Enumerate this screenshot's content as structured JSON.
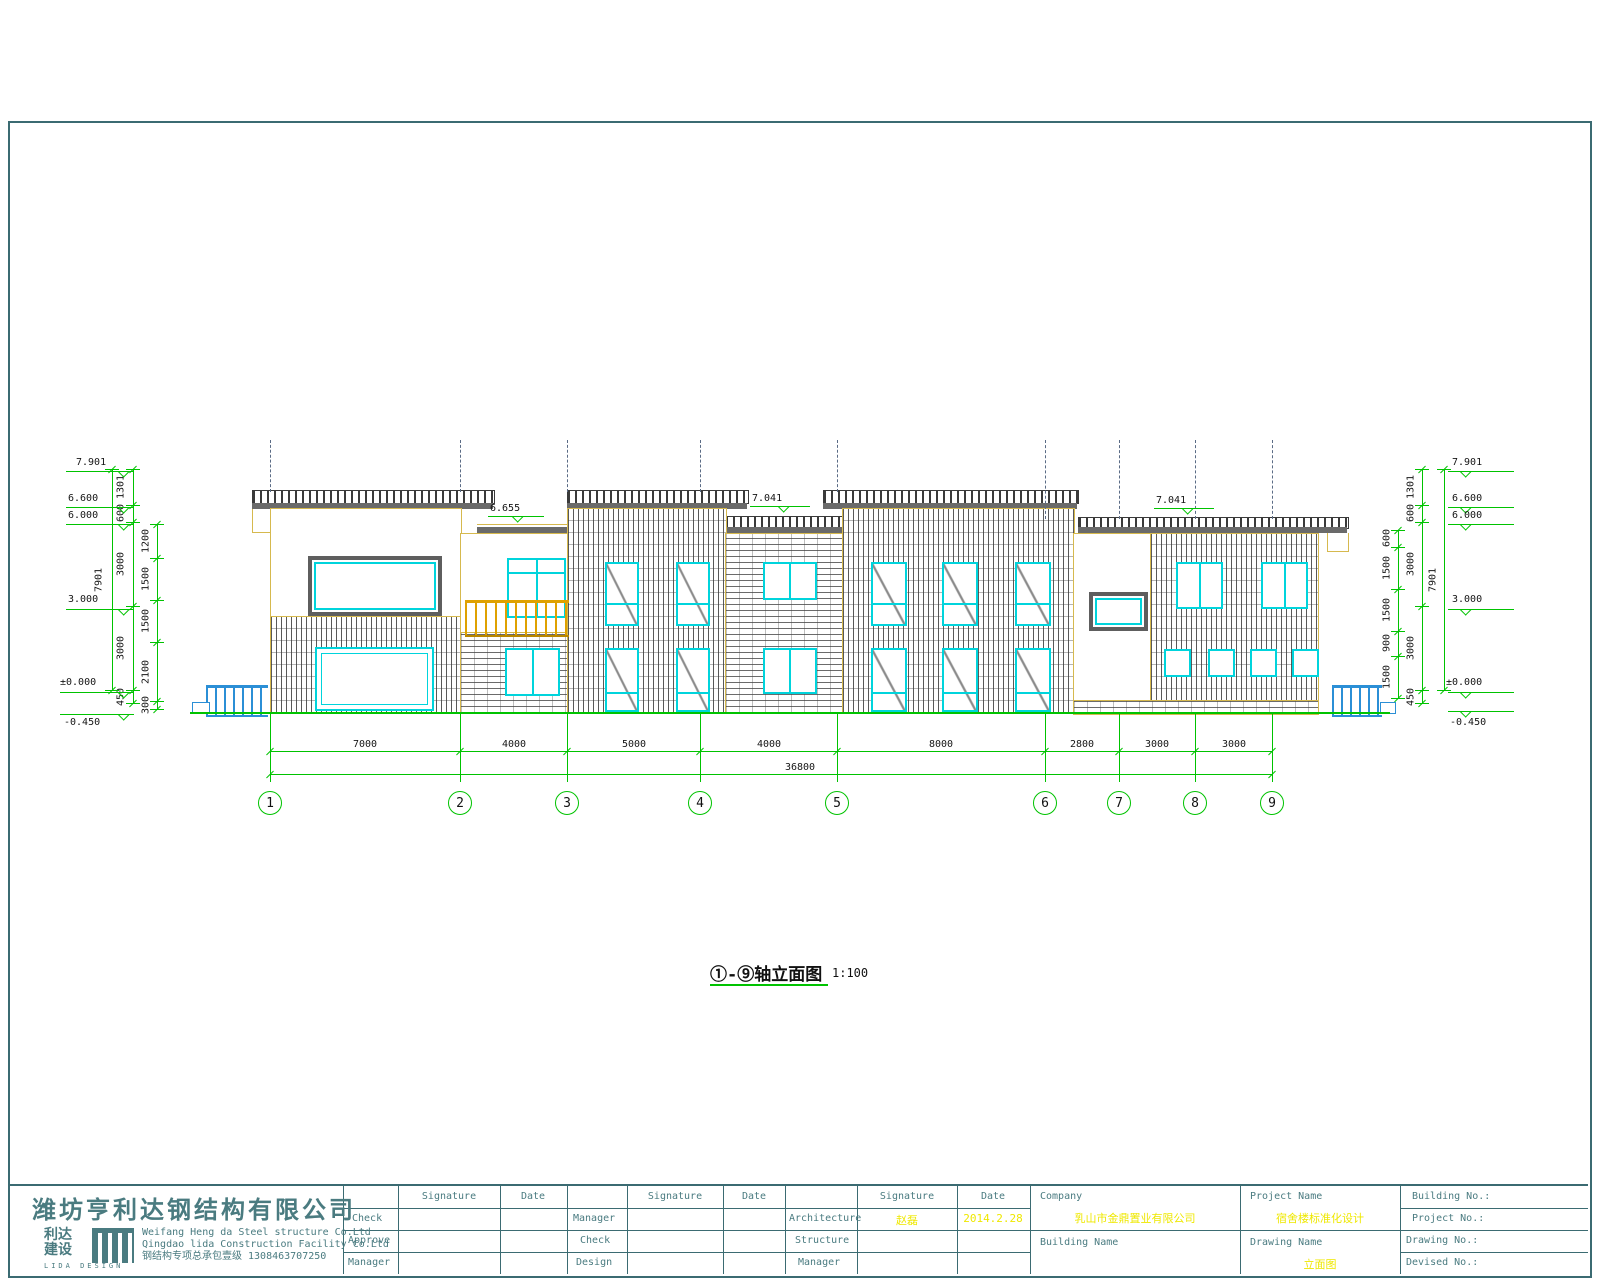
{
  "title": {
    "text": "①-⑨轴立面图",
    "scale": "1:100"
  },
  "axes": [
    "1",
    "2",
    "3",
    "4",
    "5",
    "6",
    "7",
    "8",
    "9"
  ],
  "dims": {
    "bottom": [
      "7000",
      "4000",
      "5000",
      "4000",
      "8000",
      "2800",
      "3000",
      "3000"
    ],
    "total": "36800",
    "roof": {
      "left": "6.655",
      "mid": "7.041",
      "right": "7.041"
    },
    "left": {
      "levels": [
        "7.901",
        "6.600",
        "6.000",
        "3.000",
        "±0.000",
        "-0.450"
      ],
      "chain_inner": [
        "1301",
        "600",
        "3000",
        "3000",
        "450"
      ],
      "chain_outer": [
        "1200",
        "1500",
        "1500",
        "2100",
        "300"
      ],
      "overall": [
        "7901"
      ]
    },
    "right": {
      "levels": [
        "7.901",
        "6.600",
        "6.000",
        "3.000",
        "±0.000",
        "-0.450"
      ],
      "chain_inner": [
        "1301",
        "600",
        "3000",
        "3000",
        "450"
      ],
      "chain_outer": [
        "600",
        "1500",
        "1500",
        "900",
        "1500"
      ],
      "overall": [
        "7901"
      ]
    }
  },
  "titleblock": {
    "designer_cn": "潍坊亨利达钢结构有限公司",
    "logo": {
      "line1": "利达",
      "line2": "建设",
      "sub": "LIDA DESIGN"
    },
    "designer_en1": "Weifang Heng da Steel structure Co.Ltd",
    "designer_en2": "Qingdao lida Construction Facility Co.Ltd",
    "designer_cn2": "钢结构专项总承包壹级 1308463707250",
    "header": {
      "signature": "Signature",
      "date": "Date"
    },
    "group1": {
      "rows": [
        "Check",
        "Approve",
        "Manager"
      ]
    },
    "group2": {
      "rows": [
        "Manager",
        "Check",
        "Design"
      ]
    },
    "group3": {
      "rows": [
        "Architecture",
        "Structure",
        "Manager"
      ],
      "sig1": "赵磊",
      "date1": "2014.2.28"
    },
    "company_label": "Company",
    "company_value": "乳山市金鼎置业有限公司",
    "building_name_label": "Building Name",
    "project_name_label": "Project Name",
    "project_name_value": "宿舍楼标准化设计",
    "drawing_name_label": "Drawing Name",
    "drawing_name_value": "立面图",
    "numbers": [
      "Building No.:",
      "Project No.:",
      "Drawing No.:",
      "Devised No.:"
    ]
  },
  "colors": {
    "dimension_green": "#00c300",
    "window_cyan": "#00d4dc",
    "wall_outline_yellow": "#d6b94e",
    "railing_yellow": "#dfa100",
    "railing_blue": "#2b8fd6",
    "frame_teal": "#3b6b72",
    "annotation_yellow": "#efe800"
  }
}
